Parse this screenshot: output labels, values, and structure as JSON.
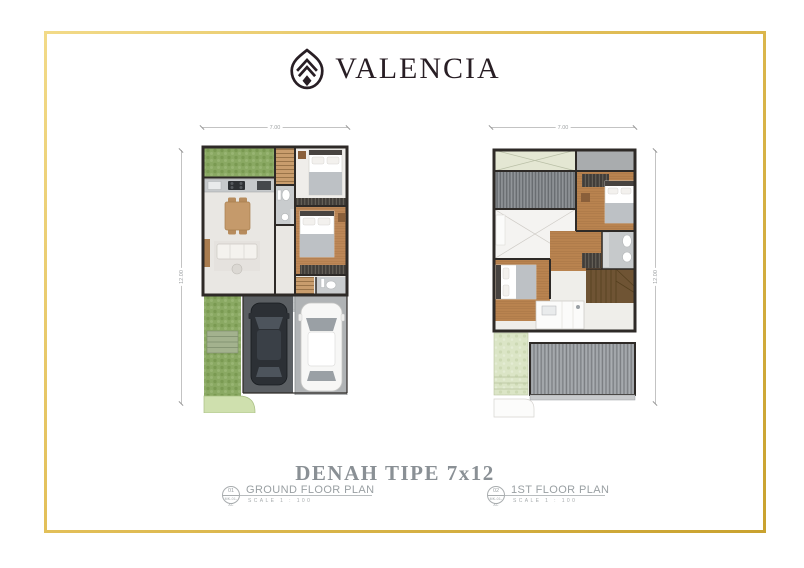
{
  "header": {
    "brand": "VALENCIA",
    "logo_icon": "valencia-leaf-monogram"
  },
  "title": "DENAH TIPE 7x12",
  "plans": {
    "ground": {
      "number": "01",
      "sheet_code": "MK-01-AC",
      "label": "GROUND FLOOR PLAN",
      "scale": "SCALE 1 : 100",
      "dimensions": {
        "width": "7.00",
        "height": "12.00"
      }
    },
    "first": {
      "number": "02",
      "sheet_code": "MK-01-AC",
      "label": "1ST FLOOR PLAN",
      "scale": "SCALE 1 : 100",
      "dimensions": {
        "width": "7.00",
        "height": "12.00"
      }
    }
  },
  "colors": {
    "frame_gold": "#ddba50",
    "brand_ink": "#281e24",
    "title_gray": "#8a9095",
    "caption_gray": "#9aa0a3",
    "dim_gray": "#a0a3a5",
    "rule_gray": "#b9bdbf"
  }
}
